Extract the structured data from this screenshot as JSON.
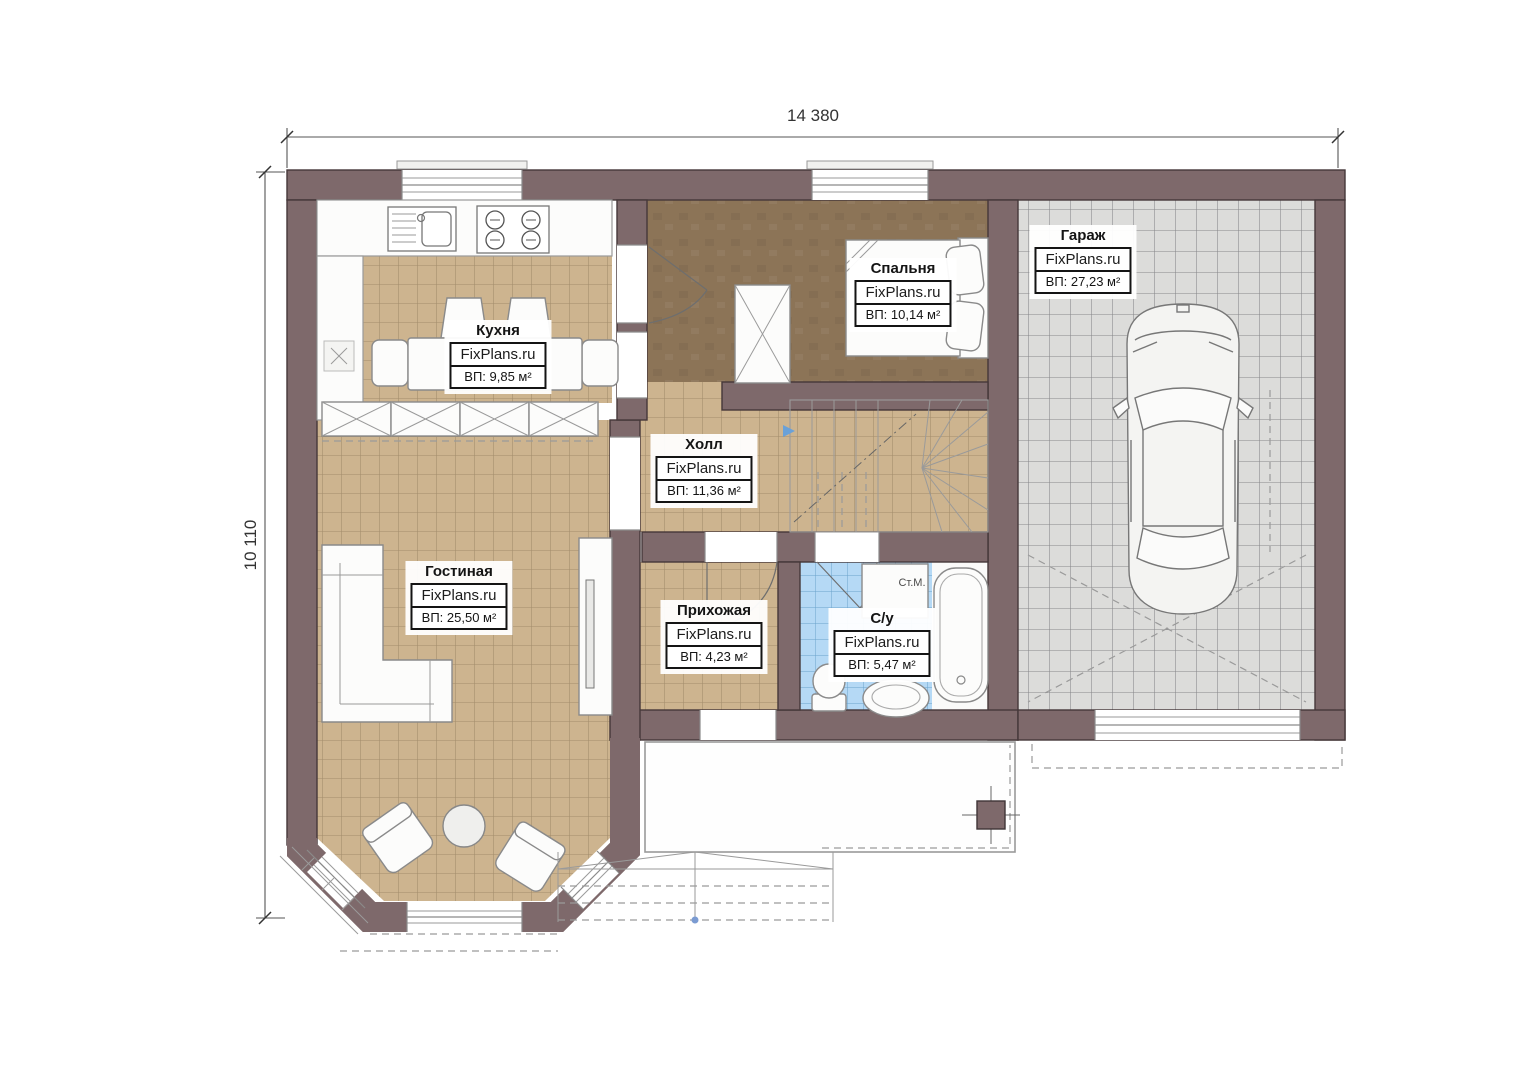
{
  "dimensions": {
    "width_label": "14 380",
    "height_label": "10 110"
  },
  "rooms": [
    {
      "id": "kitchen",
      "name": "Кухня",
      "brand": "FixPlans.ru",
      "area": "ВП: 9,85 м²"
    },
    {
      "id": "bedroom",
      "name": "Спальня",
      "brand": "FixPlans.ru",
      "area": "ВП: 10,14 м²"
    },
    {
      "id": "garage",
      "name": "Гараж",
      "brand": "FixPlans.ru",
      "area": "ВП: 27,23 м²"
    },
    {
      "id": "hall",
      "name": "Холл",
      "brand": "FixPlans.ru",
      "area": "ВП: 11,36 м²"
    },
    {
      "id": "living",
      "name": "Гостиная",
      "brand": "FixPlans.ru",
      "area": "ВП: 25,50 м²"
    },
    {
      "id": "entryway",
      "name": "Прихожая",
      "brand": "FixPlans.ru",
      "area": "ВП: 4,23 м²"
    },
    {
      "id": "bathroom",
      "name": "С/у",
      "brand": "FixPlans.ru",
      "area": "ВП: 5,47 м²"
    }
  ],
  "annotations": {
    "washing_machine": "Ст.М."
  },
  "colors": {
    "wall": "#7e696b",
    "tile_floor": "#cdb48f",
    "bedroom_floor": "#8c7457",
    "garage_floor": "#dcdcda",
    "bathroom_floor": "#b5d9f5"
  }
}
